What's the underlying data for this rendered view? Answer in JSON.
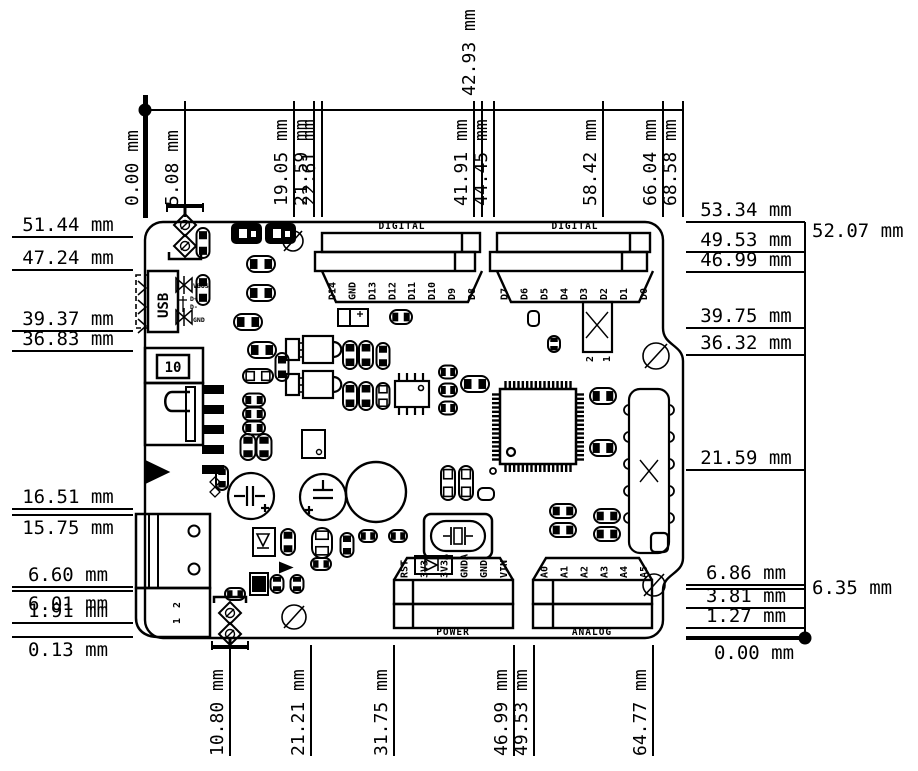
{
  "figure": {
    "unit": "mm",
    "colors": {
      "ink": "#000000",
      "paper": "#ffffff"
    }
  },
  "dimensions": {
    "top": [
      {
        "value": "0.00",
        "style": "origin"
      },
      {
        "value": "5.08"
      },
      {
        "value": "19.05"
      },
      {
        "value": "21.59"
      },
      {
        "value": "22.61"
      },
      {
        "value": "41.91"
      },
      {
        "value": "42.93",
        "style": "above"
      },
      {
        "value": "44.45"
      },
      {
        "value": "58.42"
      },
      {
        "value": "66.04"
      },
      {
        "value": "68.58"
      }
    ],
    "bottom": [
      {
        "value": "10.80"
      },
      {
        "value": "21.21"
      },
      {
        "value": "31.75"
      },
      {
        "value": "46.99"
      },
      {
        "value": "49.53"
      },
      {
        "value": "64.77"
      }
    ],
    "left": [
      {
        "value": "51.44"
      },
      {
        "value": "47.24"
      },
      {
        "value": "39.37"
      },
      {
        "value": "36.83"
      },
      {
        "value": "16.51"
      },
      {
        "value": "15.75",
        "style": "below"
      },
      {
        "value": "6.60"
      },
      {
        "value": "6.01",
        "style": "below"
      },
      {
        "value": "1.91"
      },
      {
        "value": "0.13",
        "style": "below"
      }
    ],
    "right": [
      {
        "value": "53.34"
      },
      {
        "value": "52.07",
        "style": "outside"
      },
      {
        "value": "49.53"
      },
      {
        "value": "46.99"
      },
      {
        "value": "39.75"
      },
      {
        "value": "36.32"
      },
      {
        "value": "21.59"
      },
      {
        "value": "6.86"
      },
      {
        "value": "6.35",
        "style": "outside-line"
      },
      {
        "value": "3.81"
      },
      {
        "value": "1.27"
      },
      {
        "value": "0.00",
        "style": "baseline"
      }
    ]
  },
  "board": {
    "headers": [
      {
        "name": "DIGITAL",
        "side": "top",
        "pins": [
          "D14",
          "GND",
          "D13",
          "D12",
          "D11",
          "D10",
          "D9",
          "D8"
        ]
      },
      {
        "name": "DIGITAL",
        "side": "top",
        "pins": [
          "D7",
          "D6",
          "D5",
          "D4",
          "D3",
          "D2",
          "D1",
          "D0"
        ]
      },
      {
        "name": "POWER",
        "side": "bottom",
        "pins": [
          "RST",
          "3V3",
          "3V3A",
          "GNDA",
          "GND",
          "VIN"
        ]
      },
      {
        "name": "ANALOG",
        "side": "bottom",
        "pins": [
          "A0",
          "A1",
          "A2",
          "A3",
          "A4",
          "A5"
        ]
      }
    ],
    "usb": {
      "label": "USB",
      "signals": [
        "VBUS",
        "D+",
        "D-",
        "GND"
      ]
    },
    "silkscreen": {
      "ref_10": "10",
      "jack_pins": [
        "2",
        "1"
      ],
      "aux_pins": [
        "2",
        "1"
      ]
    }
  }
}
